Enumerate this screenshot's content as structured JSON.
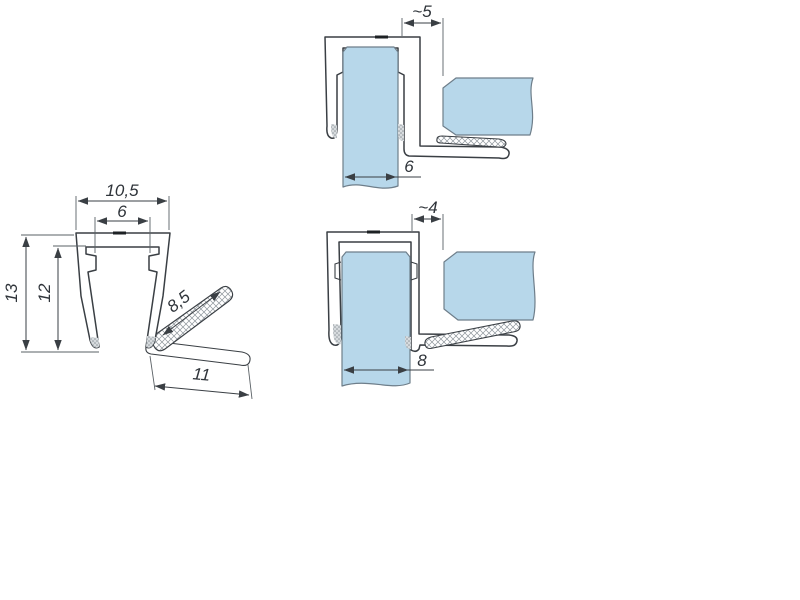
{
  "figure": {
    "type": "technical-drawing",
    "description": "Shower seal profile: cross-section with dimensions and two glass installation details",
    "colors": {
      "glass_fill": "#b7d7ea",
      "glass_edge": "#6e7e8a",
      "line": "#3a3f44",
      "dim_text": "#2f343a",
      "background": "#ffffff"
    },
    "profile_view": {
      "dims": {
        "top_width": "10,5",
        "channel_width": "6",
        "outer_height": "13",
        "inner_height": "12",
        "flap_length": "8,5",
        "arm_length": "11"
      }
    },
    "detail_6mm": {
      "dims": {
        "gap": "~5",
        "glass_thickness": "6"
      }
    },
    "detail_8mm": {
      "dims": {
        "gap": "~4",
        "glass_thickness": "8"
      }
    }
  }
}
